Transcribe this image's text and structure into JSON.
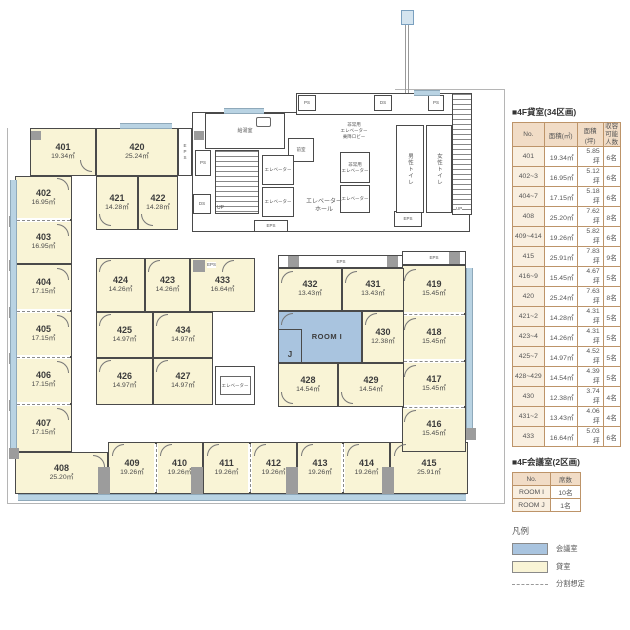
{
  "rental_table": {
    "title": "■4F貸室(34区画)",
    "headers": {
      "no": "No.",
      "area_m2": "面積(㎡)",
      "area_tsubo": "面積(坪)",
      "capacity": "収容可能\n人数"
    },
    "rows": [
      {
        "no": "401",
        "m2": "19.34㎡",
        "tsubo": "5.85坪",
        "cap": "6名"
      },
      {
        "no": "402~3",
        "m2": "16.95㎡",
        "tsubo": "5.12坪",
        "cap": "6名"
      },
      {
        "no": "404~7",
        "m2": "17.15㎡",
        "tsubo": "5.18坪",
        "cap": "6名"
      },
      {
        "no": "408",
        "m2": "25.20㎡",
        "tsubo": "7.62坪",
        "cap": "8名"
      },
      {
        "no": "409~414",
        "m2": "19.26㎡",
        "tsubo": "5.82坪",
        "cap": "6名"
      },
      {
        "no": "415",
        "m2": "25.91㎡",
        "tsubo": "7.83坪",
        "cap": "9名"
      },
      {
        "no": "416~9",
        "m2": "15.45㎡",
        "tsubo": "4.67坪",
        "cap": "5名"
      },
      {
        "no": "420",
        "m2": "25.24㎡",
        "tsubo": "7.63坪",
        "cap": "8名"
      },
      {
        "no": "421~2",
        "m2": "14.28㎡",
        "tsubo": "4.31坪",
        "cap": "5名"
      },
      {
        "no": "423~4",
        "m2": "14.26㎡",
        "tsubo": "4.31坪",
        "cap": "5名"
      },
      {
        "no": "425~7",
        "m2": "14.97㎡",
        "tsubo": "4.52坪",
        "cap": "5名"
      },
      {
        "no": "428~429",
        "m2": "14.54㎡",
        "tsubo": "4.39坪",
        "cap": "5名"
      },
      {
        "no": "430",
        "m2": "12.38㎡",
        "tsubo": "3.74坪",
        "cap": "4名"
      },
      {
        "no": "431~2",
        "m2": "13.43㎡",
        "tsubo": "4.06坪",
        "cap": "4名"
      },
      {
        "no": "433",
        "m2": "16.64㎡",
        "tsubo": "5.03坪",
        "cap": "6名"
      }
    ]
  },
  "meeting_table": {
    "title": "■4F会議室(2区画)",
    "headers": {
      "no": "No.",
      "seats": "席数"
    },
    "rows": [
      {
        "no": "ROOM I",
        "seats": "10名"
      },
      {
        "no": "ROOM J",
        "seats": "1名"
      }
    ]
  },
  "legend": {
    "title": "凡例",
    "meeting": "会議室",
    "rental": "貸室",
    "division": "分割想定"
  },
  "colors": {
    "rental_fill": "#f9f4d6",
    "meeting_fill": "#a9c4df",
    "wall": "#4a4a4a",
    "window": "#b9d3e3",
    "table_border": "#bd9469"
  },
  "plan": {
    "rooms": {
      "r401": {
        "no": "401",
        "area": "19.34㎡"
      },
      "r402": {
        "no": "402",
        "area": "16.95㎡"
      },
      "r403": {
        "no": "403",
        "area": "16.95㎡"
      },
      "r404": {
        "no": "404",
        "area": "17.15㎡"
      },
      "r405": {
        "no": "405",
        "area": "17.15㎡"
      },
      "r406": {
        "no": "406",
        "area": "17.15㎡"
      },
      "r407": {
        "no": "407",
        "area": "17.15㎡"
      },
      "r408": {
        "no": "408",
        "area": "25.20㎡"
      },
      "r409": {
        "no": "409",
        "area": "19.26㎡"
      },
      "r410": {
        "no": "410",
        "area": "19.26㎡"
      },
      "r411": {
        "no": "411",
        "area": "19.26㎡"
      },
      "r412": {
        "no": "412",
        "area": "19.26㎡"
      },
      "r413": {
        "no": "413",
        "area": "19.26㎡"
      },
      "r414": {
        "no": "414",
        "area": "19.26㎡"
      },
      "r415": {
        "no": "415",
        "area": "25.91㎡"
      },
      "r416": {
        "no": "416",
        "area": "15.45㎡"
      },
      "r417": {
        "no": "417",
        "area": "15.45㎡"
      },
      "r418": {
        "no": "418",
        "area": "15.45㎡"
      },
      "r419": {
        "no": "419",
        "area": "15.45㎡"
      },
      "r420": {
        "no": "420",
        "area": "25.24㎡"
      },
      "r421": {
        "no": "421",
        "area": "14.28㎡"
      },
      "r422": {
        "no": "422",
        "area": "14.28㎡"
      },
      "r423": {
        "no": "423",
        "area": "14.26㎡"
      },
      "r424": {
        "no": "424",
        "area": "14.26㎡"
      },
      "r425": {
        "no": "425",
        "area": "14.97㎡"
      },
      "r426": {
        "no": "426",
        "area": "14.97㎡"
      },
      "r427": {
        "no": "427",
        "area": "14.97㎡"
      },
      "r428": {
        "no": "428",
        "area": "14.54㎡"
      },
      "r429": {
        "no": "429",
        "area": "14.54㎡"
      },
      "r430": {
        "no": "430",
        "area": "12.38㎡"
      },
      "r431": {
        "no": "431",
        "area": "13.43㎡"
      },
      "r432": {
        "no": "432",
        "area": "13.43㎡"
      },
      "r433": {
        "no": "433",
        "area": "16.64㎡"
      },
      "r434": {
        "no": "434",
        "area": "14.97㎡"
      }
    },
    "meeting_rooms": {
      "room_i": "ROOM I",
      "room_j": "J"
    },
    "labels": {
      "eps": "EPS",
      "ps": "PS",
      "ds": "DS",
      "up": "UP",
      "kyutoshitsu": "給湯室",
      "zenshitsu": "前室",
      "elevator": "エレベーター",
      "elevator_hall": "エレベーター\nホール",
      "emergency_elevator": "非常用\nエレベーター",
      "emergency_lobby": "非常用\nエレベーター\n乗降ロビー",
      "mens_toilet": "男性トイレ",
      "womens_toilet": "女性トイレ"
    }
  }
}
